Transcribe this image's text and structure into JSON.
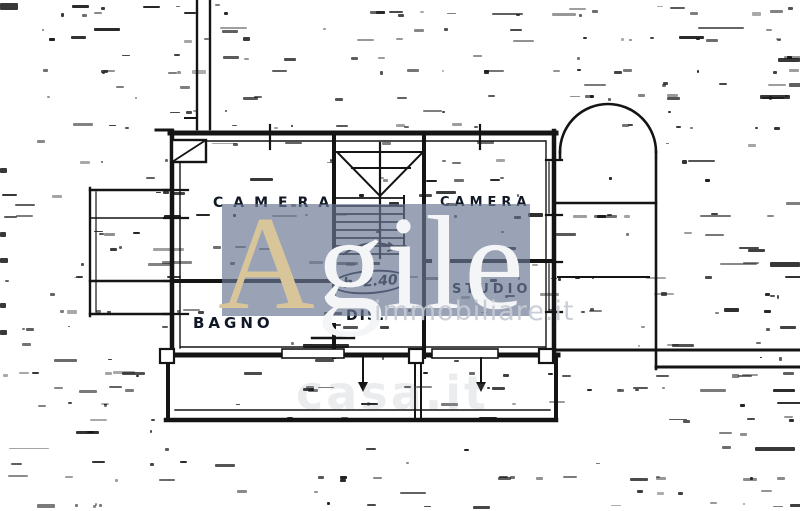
{
  "floorplan": {
    "ink_color": "#141414",
    "room_labels": [
      {
        "id": "camera-left",
        "text": "CAMERA"
      },
      {
        "id": "camera-right",
        "text": "CAMERA"
      },
      {
        "id": "bagno",
        "text": "BAGNO"
      },
      {
        "id": "dis",
        "text": "DIS."
      },
      {
        "id": "studio",
        "text": "STUDIO"
      }
    ],
    "annotations": [
      {
        "id": "ceiling-height",
        "text": "h. 2.40"
      }
    ]
  },
  "watermarks": {
    "agile": {
      "first_letter": "A",
      "rest": "gile",
      "tagline": "immobiliare.it",
      "panel_color": "#6a7794",
      "panel_opacity": "0.68",
      "first_letter_color": "#d8c69a",
      "rest_color": "#f4f5f7",
      "tagline_color": "#c6cbd4"
    },
    "faint": {
      "text": "casa.it",
      "color": "#8d949c"
    }
  }
}
